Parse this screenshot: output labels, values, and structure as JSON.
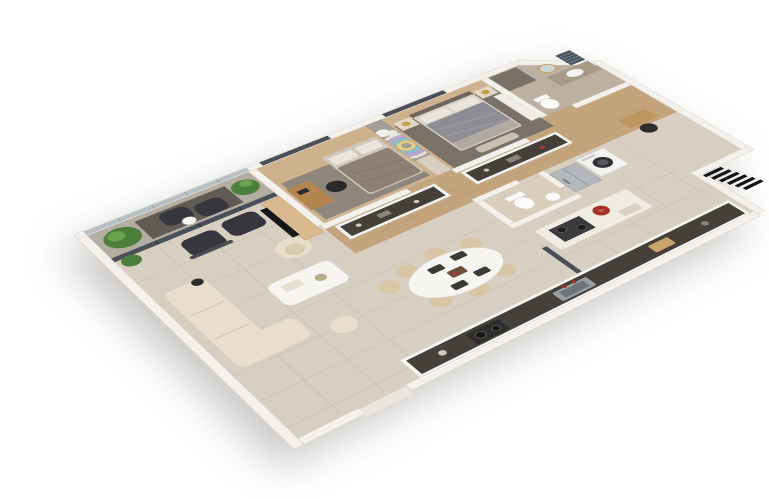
{
  "window": {
    "background": "#ffffff",
    "description": "3D isometric floor plan rendering of a two-bedroom apartment, viewed from above at an angle on a plain white background"
  },
  "palette": {
    "wall": "#f4f1ec",
    "wall_edge": "#d8d2c9",
    "floor": "#d8cfc3",
    "floor_line": "#c6bcae",
    "wood": "#c3a47c",
    "wood_dark": "#ab8a60",
    "kids_wood": "#cdb28d",
    "rug_gray": "#8f877d",
    "master_rug": "#7a7169",
    "balcony_floor": "#b3ada4",
    "balcony_rug": "#605c55",
    "glass": "#49505a",
    "railing_glass": "#b7c0c4",
    "plant": "#4d7f3c",
    "plant_light": "#6aa04e",
    "dark_furniture": "#36373c",
    "cream": "#e9decb",
    "white_furniture": "#f7f5f1",
    "tv_black": "#16171a",
    "console_wood": "#d8ba8e",
    "master_duvet": "#8d8d93",
    "kids_duvet": "#8d8173",
    "pillow": "#eae6de",
    "steel": "#b4b8bd",
    "counter_dark": "#45413a",
    "island_white": "#f0ebe3",
    "accent_red": "#a33227",
    "lamp_gold": "#c8a050",
    "bath_tile": "#bdb0a0",
    "shower_tile": "#7a7065",
    "stone_counter": "#a79a88",
    "washer_white": "#f3f3f1",
    "louver_black": "#141416",
    "rainbow_wall": "#a19f9a",
    "rainbow_purple": "#b9a7da",
    "rainbow_teal": "#85c3cf",
    "rainbow_yellow": "#e3cf7e"
  },
  "floorplan": {
    "rooms": [
      {
        "name": "balcony",
        "furniture": [
          "potted-plant",
          "potted-plant",
          "bean-bag-chair",
          "bean-bag-chair",
          "side-table",
          "glass-railing"
        ]
      },
      {
        "name": "living-room",
        "furniture": [
          "sofa-chaise",
          "coffee-table",
          "pouf",
          "barrel-chair",
          "armchair",
          "armchair",
          "tv-console",
          "tv",
          "floor-lamp",
          "plant"
        ]
      },
      {
        "name": "kids-bedroom",
        "furniture": [
          "bed",
          "desk",
          "desk-chair",
          "area-rug",
          "window",
          "rainbow-mural-wall"
        ]
      },
      {
        "name": "master-bedroom",
        "furniture": [
          "double-bed",
          "nightstand",
          "nightstand",
          "table-lamp",
          "table-lamp",
          "foot-bench",
          "wardrobe",
          "area-rug",
          "window"
        ]
      },
      {
        "name": "bathroom",
        "furniture": [
          "vanity-counter",
          "vessel-sink",
          "round-mirror",
          "window-blinds",
          "toilet",
          "shower-area"
        ]
      },
      {
        "name": "hallway",
        "furniture": [
          "dresser-counter",
          "dresser-counter",
          "small-desk",
          "chair"
        ]
      },
      {
        "name": "wc",
        "furniture": [
          "toilet",
          "small-sink"
        ]
      },
      {
        "name": "utility",
        "furniture": [
          "washing-machine",
          "refrigerator"
        ]
      },
      {
        "name": "dining-area",
        "furniture": [
          "oval-dining-table",
          "dining-chair",
          "dining-chair",
          "dining-chair",
          "dining-chair",
          "dining-chair",
          "dining-chair"
        ]
      },
      {
        "name": "kitchen",
        "furniture": [
          "island-with-cooktop",
          "red-pot",
          "wall-counter",
          "sink",
          "portable-stove",
          "glass-partition",
          "entry-step",
          "exterior-louver"
        ]
      }
    ]
  }
}
